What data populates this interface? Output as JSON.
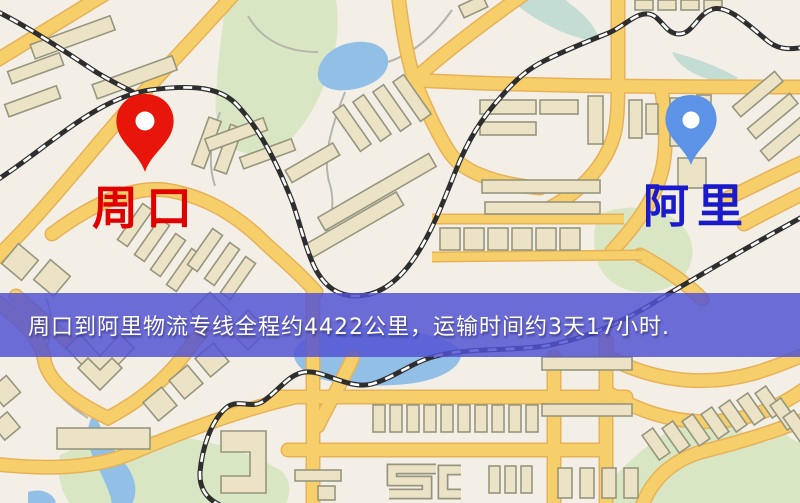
{
  "map": {
    "origin_marker": {
      "icon": "map-pin-icon",
      "label": "周口",
      "pin_color": "#e8150a",
      "label_color": "#e00000"
    },
    "destination_marker": {
      "icon": "map-pin-icon",
      "label": "阿里",
      "pin_color": "#5c93e6",
      "label_color": "#1a1acc"
    },
    "info_banner": {
      "text": "周口到阿里物流专线全程约4422公里，运输时间约3天17小时.",
      "background_color": "#5252d4",
      "text_color": "#ffffff",
      "route": {
        "from": "周口",
        "to": "阿里",
        "distance_km": 4422,
        "duration": "3天17小时"
      }
    },
    "style_colors": {
      "background": "#f3efe7",
      "road": "#f6cf6a",
      "road_casing": "#e7b158",
      "railway": "#2e2e2e",
      "water": "#92bfe6",
      "green_area": "#d9e6c3",
      "building": "#ece3c7",
      "building_outline": "#96967e"
    }
  }
}
